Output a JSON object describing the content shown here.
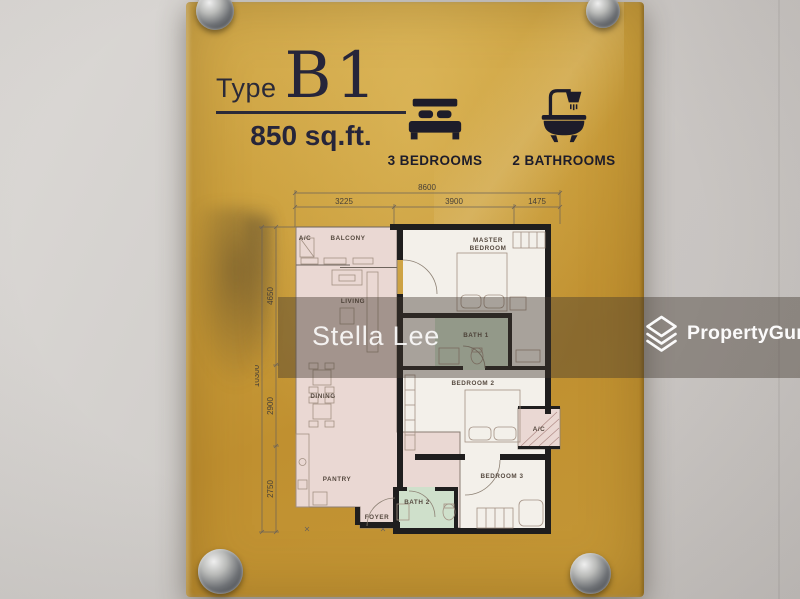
{
  "sign": {
    "type_label": "Type",
    "type_value": "B1",
    "area": "850 sq.ft.",
    "bedrooms_label": "3 BEDROOMS",
    "bathrooms_label": "2 BATHROOMS"
  },
  "floorplan": {
    "dimensions": {
      "top_total": "8600",
      "top_segments": [
        "3225",
        "3900",
        "1475"
      ],
      "left_total": "10300",
      "left_segments": [
        "4650",
        "2900",
        "2750"
      ]
    },
    "rooms": {
      "ac_balcony": "A/C",
      "balcony": "BALCONY",
      "master_line1": "MASTER",
      "master_line2": "BEDROOM",
      "living": "LIVING",
      "bath1": "BATH 1",
      "dining": "DINING",
      "bedroom2": "BEDROOM 2",
      "ac_service": "A/C",
      "pantry": "PANTRY",
      "bedroom3": "BEDROOM 3",
      "bath2": "BATH 2",
      "foyer": "FOYER"
    }
  },
  "watermark": {
    "agent_name": "Stella Lee",
    "brand": "PropertyGuru"
  },
  "colors": {
    "plaque_gold": "#c89b38",
    "ink_dark": "#26253a",
    "room_pink": "#ead8d3",
    "room_white": "#f3f0ea",
    "bath_green": "#cfe0cb",
    "wall_black": "#1f1e1e",
    "overlay": "rgba(64,54,46,0.42)"
  }
}
